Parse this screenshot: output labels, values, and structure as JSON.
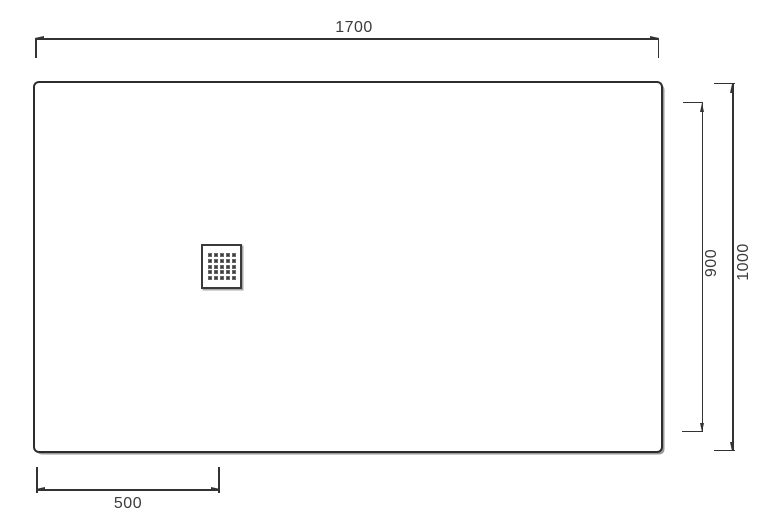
{
  "diagram": {
    "dimensions": {
      "overall_width": "1700",
      "overall_depth": "1000",
      "inner_depth": "900",
      "drain_offset": "500"
    },
    "colors": {
      "line": "#333333",
      "text": "#3b3b3b",
      "shadow": "#9a9a9a",
      "background": "#ffffff"
    },
    "icons": {
      "drain_grate": "5x5-square-dot-grid"
    }
  }
}
